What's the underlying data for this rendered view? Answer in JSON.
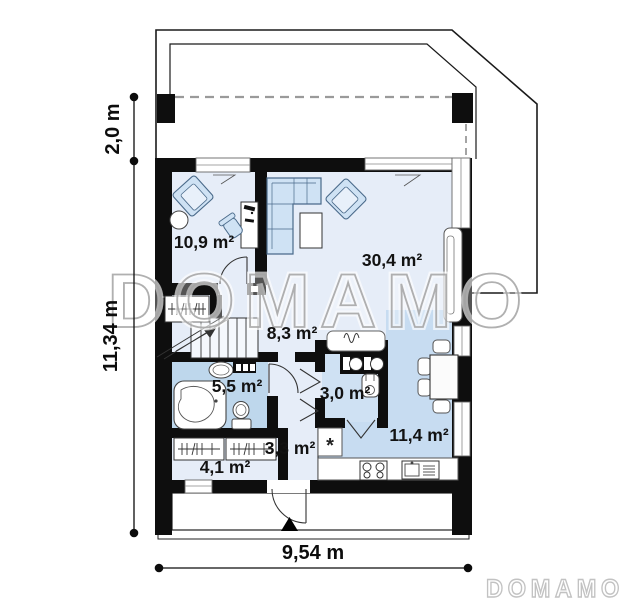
{
  "watermark": {
    "center_text": "DOMAMO",
    "footer_logo": "DOMAMO"
  },
  "dimensions": {
    "terrace_depth": "2,0 m",
    "house_depth": "11,34 m",
    "house_width": "9,54 m"
  },
  "rooms": [
    {
      "name": "cabinet",
      "area_label": "10,9 m²"
    },
    {
      "name": "living-room",
      "area_label": "30,4 m²"
    },
    {
      "name": "hall",
      "area_label": "8,3 m²"
    },
    {
      "name": "bathroom",
      "area_label": "5,5 m²"
    },
    {
      "name": "utility",
      "area_label": "3,0 m²"
    },
    {
      "name": "entry",
      "area_label": "3,3 m²"
    },
    {
      "name": "wardrobe",
      "area_label": "4,1 m²"
    },
    {
      "name": "kitchen",
      "area_label": "11,4 m²"
    }
  ],
  "symbols": {
    "fridge": "*"
  },
  "colors": {
    "wall": "#0e0e0e",
    "floor_light": "#e6edf8",
    "floor_bath": "#bed7ec",
    "floor_utility": "#cfe1f3",
    "floor_kitchen": "#c7dcf1",
    "furniture": "#cfe2f4",
    "watermark_gray": "#a3a3a3",
    "dash_gray": "#9a9a9a"
  }
}
